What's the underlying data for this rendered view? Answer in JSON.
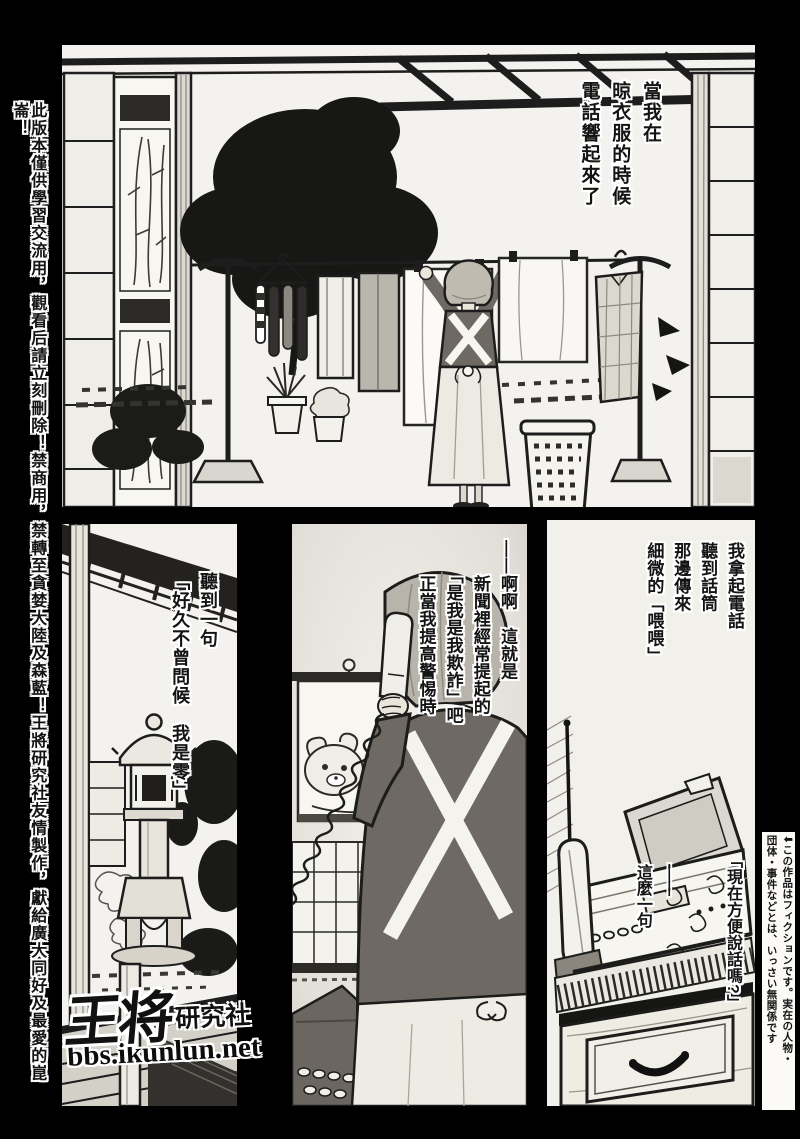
{
  "page": {
    "colors": {
      "bg": "#000000",
      "paper": "#f4f2ee",
      "ink": "#1c1c1c",
      "cloth_gray": "#6e6a63",
      "hair_gray": "#b8b4ab"
    }
  },
  "margins": {
    "left_disclaimer": "此版本僅供學習交流用，觀看后請立刻刪除！禁商用，禁轉至貪婪大陸及森藍！王將研究社友情製作，獻給廣大同好及最愛的崑崙！",
    "right_disclaimer": "⬇この作品はフィクションです。実在の人物・\n団体・事件などとは、いっさい無関係です"
  },
  "panels": [
    {
      "id": "laundry-yard",
      "narration": "當我在\n晾衣服的時候\n電話響起來了"
    },
    {
      "id": "garden-lantern",
      "narration": "聽到一句\n「好久不曾問候　我是零」"
    },
    {
      "id": "answering-phone",
      "narration": "——啊啊　這就是\n　　新聞裡經常提起的\n　　「是我是我欺詐」吧\n　　正當我提高警惕時"
    },
    {
      "id": "fax-phone",
      "narration": "我拿起電話\n聽到話筒\n那邊傳來\n細微的「喂喂」",
      "speech": "「現在方便說話嗎?」",
      "caption": "——\n這麼一句"
    }
  ],
  "logo": {
    "brand_main": "王将",
    "brand_sub": "研究社",
    "site": "bbs.ikunlun.net"
  }
}
